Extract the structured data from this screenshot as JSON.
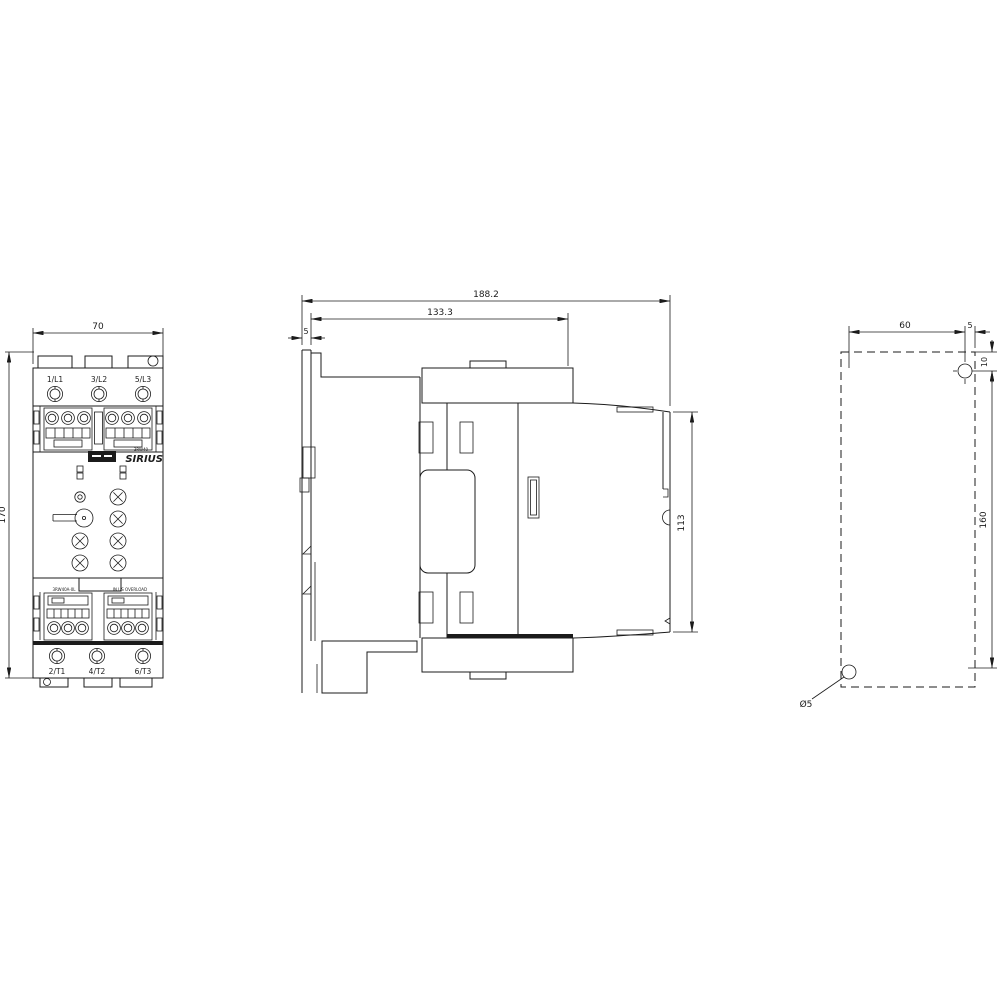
{
  "drawing": {
    "front": {
      "width_dim": "70",
      "height_dim": "170",
      "line_terminals": [
        "1/L1",
        "3/L2",
        "5/L3"
      ],
      "load_terminals": [
        "2/T1",
        "4/T2",
        "6/T3"
      ],
      "brand": "SIRIUS",
      "type_small": "3RW40",
      "aux_left_label": "3RW40A-0L",
      "aux_right_label": "IN US OVERLOAD"
    },
    "side": {
      "total_depth_dim": "188.2",
      "body_depth_dim": "133.3",
      "rail_dim": "5",
      "front_height_dim": "113"
    },
    "rear": {
      "hole_spacing_h_dim": "60",
      "edge_offset_dim": "5",
      "top_offset_dim": "10",
      "hole_spacing_v_dim": "160",
      "hole_dia_label": "Ø5"
    }
  }
}
